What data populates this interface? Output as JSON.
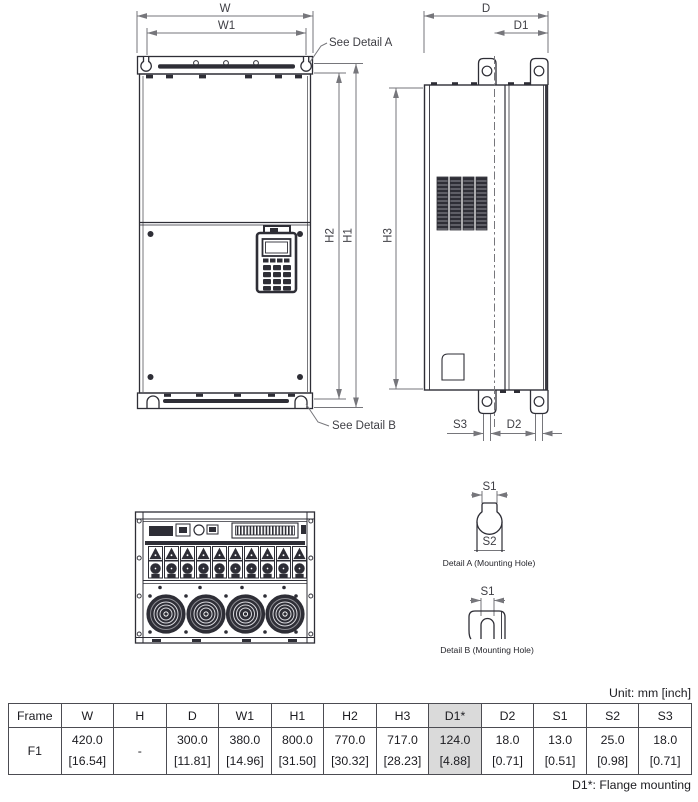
{
  "drawing": {
    "dim_labels": {
      "w": "W",
      "w1": "W1",
      "d": "D",
      "d1": "D1",
      "h1": "H1",
      "h2": "H2",
      "h3": "H3",
      "s3": "S3",
      "d2": "D2",
      "s1": "S1",
      "s2": "S2"
    },
    "callouts": {
      "detail_a": "See Detail A",
      "detail_b": "See Detail B"
    },
    "details": {
      "a_caption": "Detail A (Mounting Hole)",
      "b_caption": "Detail B (Mounting Hole)"
    }
  },
  "table": {
    "unit_note": "Unit: mm [inch]",
    "headers": [
      "Frame",
      "W",
      "H",
      "D",
      "W1",
      "H1",
      "H2",
      "H3",
      "D1*",
      "D2",
      "S1",
      "S2",
      "S3"
    ],
    "highlight_column": "D1*",
    "rows": [
      {
        "frame": "F1",
        "cells": [
          [
            "420.0",
            "[16.54]"
          ],
          [
            "-",
            ""
          ],
          [
            "300.0",
            "[11.81]"
          ],
          [
            "380.0",
            "[14.96]"
          ],
          [
            "800.0",
            "[31.50]"
          ],
          [
            "770.0",
            "[30.32]"
          ],
          [
            "717.0",
            "[28.23]"
          ],
          [
            "124.0",
            "[4.88]"
          ],
          [
            "18.0",
            "[0.71]"
          ],
          [
            "13.0",
            "[0.51]"
          ],
          [
            "25.0",
            "[0.98]"
          ],
          [
            "18.0",
            "[0.71]"
          ]
        ]
      }
    ],
    "footnote": "D1*: Flange mounting"
  },
  "colors": {
    "outline": "#2e2e36",
    "dimension": "#76767b",
    "highlight": "#dadada"
  }
}
